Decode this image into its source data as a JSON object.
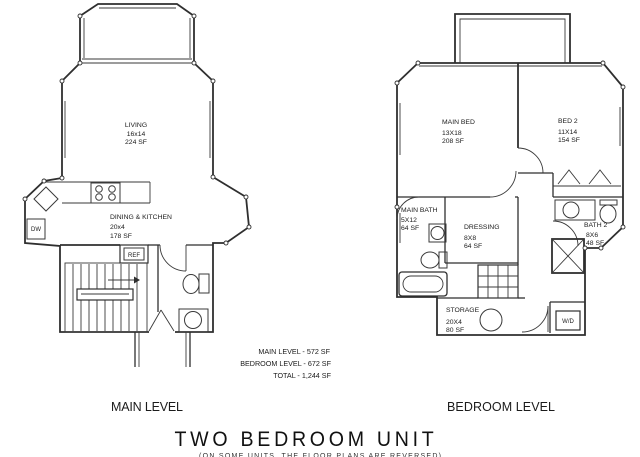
{
  "title": "TWO BEDROOM UNIT",
  "note": "(ON SOME UNITS, THE FLOOR PLANS ARE REVERSED)",
  "colors": {
    "line": "#2f2f2f",
    "text": "#1b1b1b",
    "background": "#ffffff"
  },
  "summary": {
    "main": "MAIN LEVEL - 572 SF",
    "bedroom": "BEDROOM LEVEL - 672 SF",
    "total": "TOTAL - 1,244 SF"
  },
  "main_level": {
    "caption": "MAIN LEVEL",
    "living": {
      "name": "LIVING",
      "dims": "16x14",
      "area": "224 SF"
    },
    "dining_kitchen": {
      "name": "DINING & KITCHEN",
      "dims": "20x4",
      "area": "178 SF"
    },
    "appliances": {
      "dishwasher": "DW",
      "refrigerator": "REF"
    }
  },
  "bedroom_level": {
    "caption": "BEDROOM LEVEL",
    "main_bed": {
      "name": "MAIN BED",
      "dims": "13X18",
      "area": "208 SF"
    },
    "bed2": {
      "name": "BED 2",
      "dims": "11X14",
      "area": "154 SF"
    },
    "main_bath": {
      "name": "MAIN BATH",
      "dims": "5X12",
      "area": "64 SF"
    },
    "dressing": {
      "name": "DRESSING",
      "dims": "8X8",
      "area": "64 SF"
    },
    "bath2": {
      "name": "BATH 2",
      "dims": "8X6",
      "area": "48 SF"
    },
    "storage": {
      "name": "STORAGE",
      "dims": "20X4",
      "area": "80 SF"
    },
    "washer_dryer": "W/D"
  }
}
